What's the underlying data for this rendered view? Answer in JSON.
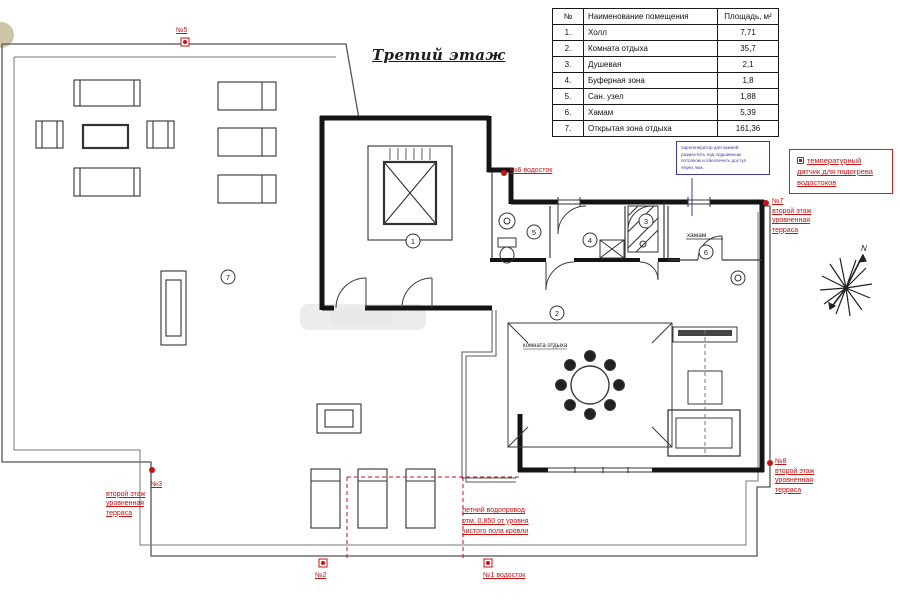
{
  "title": "Третий этаж",
  "legend": {
    "headers": [
      "№",
      "Наименование помещения",
      "Площадь, м²"
    ],
    "rows": [
      [
        "1.",
        "Холл",
        "7,71"
      ],
      [
        "2.",
        "Комната отдыха",
        "35,7"
      ],
      [
        "3.",
        "Душевая",
        "2,1"
      ],
      [
        "4.",
        "Буферная зона",
        "1,8"
      ],
      [
        "5.",
        "Сан. узел",
        "1,88"
      ],
      [
        "6.",
        "Хамам",
        "5,39"
      ],
      [
        "7.",
        "Открытая зона отдыха",
        "161,36"
      ]
    ]
  },
  "plan": {
    "numbers": [
      "1",
      "2",
      "3",
      "4",
      "5",
      "6",
      "7"
    ],
    "hamam_label": "хамам",
    "lounge_label": "комната отдыха",
    "north_label": "N"
  },
  "annotations": {
    "n5": "№5",
    "n6": "№6 водосток",
    "n2": "№2",
    "n1": "№1 водосток",
    "n7": {
      "num": "№7",
      "lines": [
        "второй этаж",
        "уровненная",
        "терраса"
      ]
    },
    "n8": {
      "num": "№8",
      "lines": [
        "второй этаж",
        "уровненная",
        "терраса"
      ]
    },
    "n3": {
      "num": "№3",
      "lines": [
        "второй этаж",
        "уровненная",
        "терраса"
      ]
    },
    "temp_sensor": [
      "температурный",
      "датчик для подогрева",
      "водостоков"
    ],
    "summer_pipe": [
      "летний водопровод",
      "отм. 0,850 от уровня",
      "чистого пола кровли"
    ],
    "steam_note": [
      "парогенератор для камней",
      "разместить под подшивным",
      "потолком и обеспечить доступ",
      "через люк."
    ]
  },
  "colors": {
    "annotation_red": "#c41414",
    "annotation_blue": "#3b3b9e",
    "wall": "#141414",
    "terrace_line": "#555555"
  }
}
